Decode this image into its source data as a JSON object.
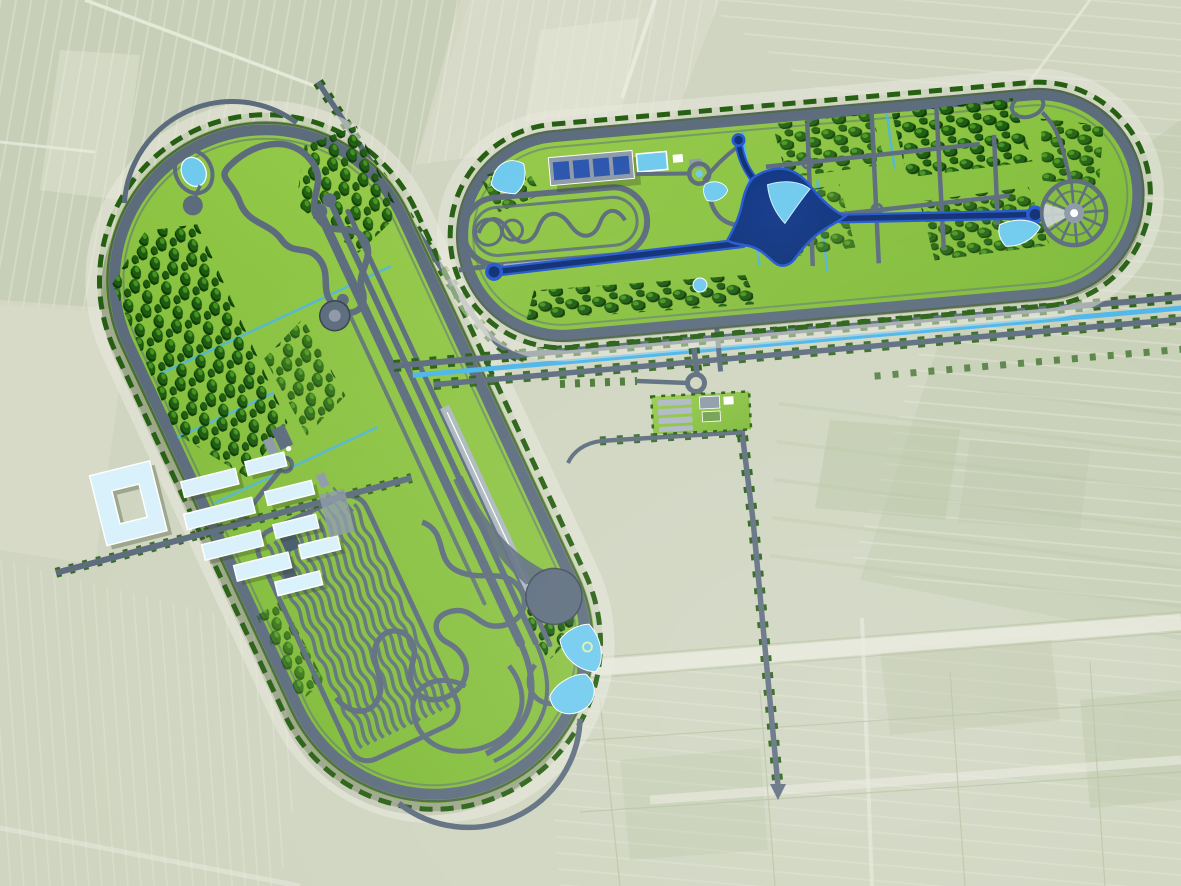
{
  "scene": {
    "type": "aerial-master-plan-rendering",
    "subject": "automotive-proving-ground-with-two-stadium-test-ovals",
    "setting": "flat-farmland-with-field-parcels"
  },
  "colors": {
    "field_base": "#cfd5c0",
    "field_light": "#e7e9d9",
    "field_dark": "#b4c19e",
    "field_pale": "#dfdfce",
    "pale_road": "#e9eadd",
    "grass_hi": "#97cb4c",
    "grass_lo": "#7cb935",
    "grass_edge": "#4f8d1d",
    "track": "#5c6c7d",
    "track_dark": "#36424d",
    "track_light": "#aeb8c3",
    "concrete": "#8d9aa7",
    "hedge": "#265f12",
    "tree_dark": "#0e3b06",
    "tree_mid": "#1d5c10",
    "tree_light": "#45941f",
    "water": "#6fcaee",
    "water_deep": "#42aadd",
    "canal": "#4bb5e9",
    "navy_core": "#0e2f74",
    "navy_mid": "#123a8c",
    "navy_rim": "#2458cf",
    "roof_light": "#d9f1fb",
    "roof_white": "#ffffff",
    "panel_blue": "#2b56ae",
    "pad_light": "#ccd3d9"
  },
  "features": {
    "west_oval": {
      "name": "west-test-oval",
      "elements": [
        "speed-ring",
        "parallel-test-straights",
        "handling-course",
        "skid-pad",
        "durability-serpentine-field",
        "braking-strip",
        "wet-pad",
        "workshop-area",
        "ponds",
        "tree-belts"
      ]
    },
    "north_oval": {
      "name": "north-test-oval",
      "elements": [
        "speed-ring",
        "vehicle-dynamics-nested-oval",
        "workshop-row-solar-roof",
        "cooling-pool",
        "star-shaped-dynamic-platform-lake",
        "west-access-straight",
        "east-access-straight",
        "road-grid-with-roundabouts",
        "radial-spoke-pad",
        "ponds",
        "woodland"
      ]
    },
    "campus": {
      "name": "rd-campus",
      "elements": [
        "courtyard-building",
        "laboratory-halls",
        "access-spine-road"
      ]
    },
    "entrance": {
      "name": "entrance-facility",
      "elements": [
        "roundabout",
        "parking-rows",
        "gate-buildings"
      ]
    },
    "infrastructure": {
      "name": "site-infrastructure",
      "elements": [
        "tree-lined-boulevard",
        "canal",
        "north-south-road",
        "diagonal-field-road",
        "field-parcel-grid"
      ]
    }
  }
}
